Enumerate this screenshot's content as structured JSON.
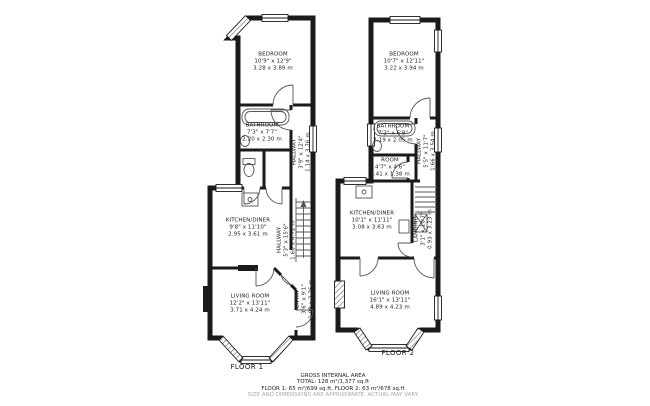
{
  "colors": {
    "walls": "#1a1a1a",
    "text": "#222222",
    "muted_text": "#a8a8a8"
  },
  "floors": [
    {
      "label": "FLOOR 1",
      "rooms": [
        {
          "name": "BEDROOM",
          "imperial": "10'9\" x 12'9\"",
          "metric": "3.28 x 3.89 m"
        },
        {
          "name": "BATHROOM",
          "imperial": "7'3\" x 7'7\"",
          "metric": "2.20 x 2.30 m"
        },
        {
          "name": "HALLWAY",
          "imperial": "3'9\" x 12'4\"",
          "metric": "1.14 x 3.76 m"
        },
        {
          "name": "KITCHEN/DINER",
          "imperial": "9'8\" x 11'10\"",
          "metric": "2.95 x 3.61 m"
        },
        {
          "name": "HALLWAY",
          "imperial": "5'3\" x 15'6\"",
          "metric": "1.60 x 4.72 m"
        },
        {
          "name": "LIVING ROOM",
          "imperial": "12'2\" x 13'11\"",
          "metric": "3.71 x 4.24 m"
        },
        {
          "name": "ENTRY",
          "imperial": "3'6\" x 9'1\"",
          "metric": "1.08 x 2.76 m"
        }
      ]
    },
    {
      "label": "FLOOR 2",
      "rooms": [
        {
          "name": "BEDROOM",
          "imperial": "10'7\" x 12'11\"",
          "metric": "3.22 x 3.94 m"
        },
        {
          "name": "BATHROOM",
          "imperial": "7'2\" x 6'9\"",
          "metric": "2.19 x 2.05 m"
        },
        {
          "name": "HALLWAY",
          "imperial": "5'5\" x 11'7\"",
          "metric": "1.66 x 3.54 m"
        },
        {
          "name": "ROOM",
          "imperial": "4'7\" x 4'6\"",
          "metric": "1.41 x 1.38 m"
        },
        {
          "name": "KITCHEN/DINER",
          "imperial": "10'1\" x 11'11\"",
          "metric": "3.08 x 3.63 m"
        },
        {
          "name": "LANDING",
          "imperial": "3'1\" x 10'7\"",
          "metric": "0.93 x 3.23 m"
        },
        {
          "name": "LIVING ROOM",
          "imperial": "16'1\" x 13'11\"",
          "metric": "4.89 x 4.23 m"
        }
      ]
    }
  ],
  "footer": {
    "line1": "GROSS INTERNAL AREA",
    "line2": "TOTAL: 128 m²/1,377 sq.ft",
    "line3": "FLOOR 1: 65 m²/699 sq.ft, FLOOR 2: 63 m²/678 sq.ft",
    "line4": "SIZE AND DIMENSIONS ARE APPROXIMATE, ACTUAL MAY VARY"
  }
}
